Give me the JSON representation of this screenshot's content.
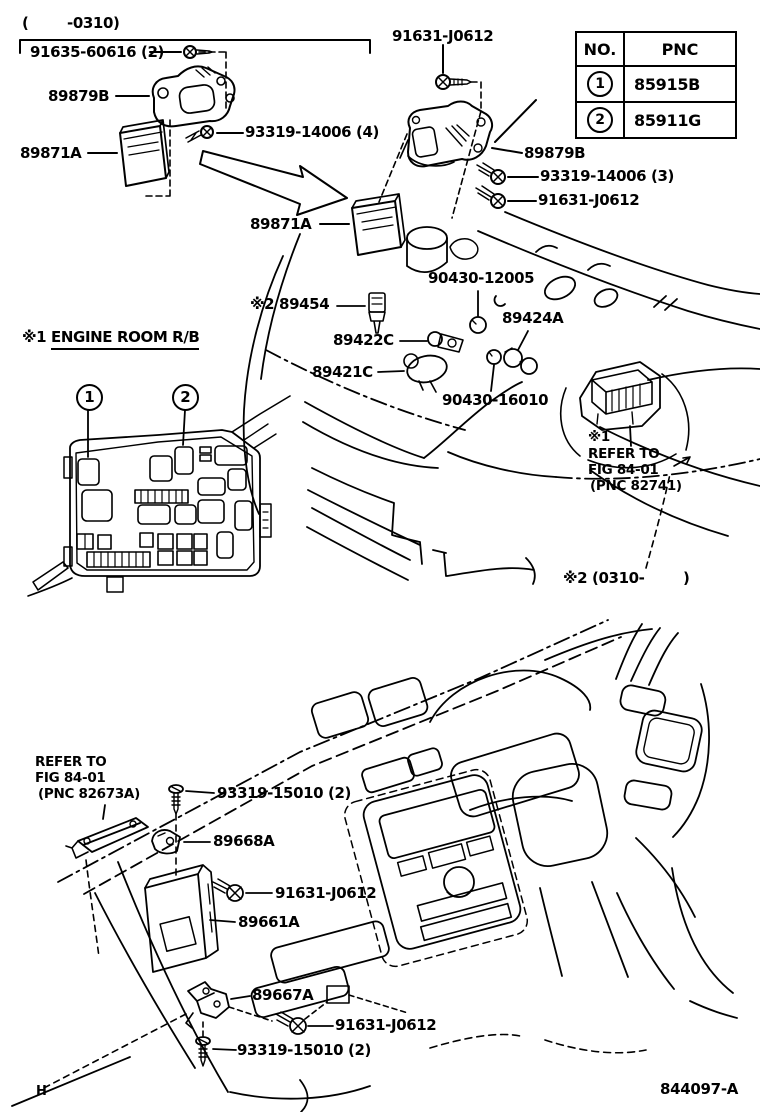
{
  "top": {
    "date_range": "(        -0310)",
    "labels": {
      "screw_91635": "91635-60616 (2)",
      "bracket_89879b_left": "89879B",
      "screw_93319_4": "93319-14006 (4)",
      "ecu_89871a_left": "89871A",
      "bolt_91631_top": "91631-J0612",
      "bracket_89879b_right": "89879B",
      "screw_93319_3": "93319-14006 (3)",
      "bolt_91631_right": "91631-J0612",
      "ecu_89871a_center": "89871A",
      "clip_90430_12005": "90430-12005",
      "sensor_89454": "※2 89454",
      "sensor_89424a": "89424A",
      "sensor_89422c": "89422C",
      "valve_89421c": "89421C",
      "clip_90430_16010": "90430-16010"
    },
    "notes": {
      "rb_marker": "※1",
      "rb_line1": "REFER TO",
      "rb_line2": "FIG 84-01",
      "rb_line3": "(PNC 82741)",
      "note_0310": "※2 (0310-        )",
      "engine_room_marker": "※1 ",
      "engine_room_text": "ENGINE ROOM R/B",
      "callout_1": "1",
      "callout_2": "2"
    }
  },
  "table": {
    "col_no": "NO.",
    "col_pnc": "PNC",
    "rows": [
      {
        "no": "1",
        "pnc": "85915B"
      },
      {
        "no": "2",
        "pnc": "85911G"
      }
    ]
  },
  "bottom": {
    "ref_line1": "REFER TO",
    "ref_line2": "FIG 84-01",
    "ref_line3": "(PNC 82673A)",
    "labels": {
      "screw_93319_top": "93319-15010 (2)",
      "bracket_89668a": "89668A",
      "bolt_91631_upper": "91631-J0612",
      "ecu_89661a": "89661A",
      "bracket_89667a": "89667A",
      "bolt_91631_lower": "91631-J0612",
      "screw_93319_bottom": "93319-15010 (2)"
    }
  },
  "footer": {
    "sheet": "H",
    "figure_number": "844097-A"
  }
}
